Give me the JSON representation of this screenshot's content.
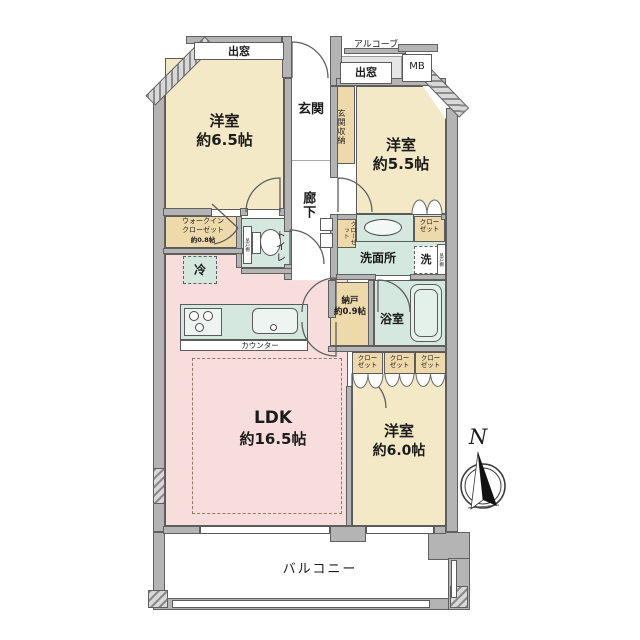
{
  "plan_type": "floor-plan",
  "rooms": {
    "bedroom_65": {
      "name": "洋室",
      "size": "約6.5帖"
    },
    "bedroom_55": {
      "name": "洋室",
      "size": "約5.5帖"
    },
    "bedroom_60": {
      "name": "洋室",
      "size": "約6.0帖"
    },
    "ldk": {
      "name": "LDK",
      "size": "約16.5帖"
    },
    "entrance": "玄関",
    "entrance_storage": "玄関収納",
    "hallway": "廊下",
    "toilet": "トイレ",
    "washroom": "洗面所",
    "bathroom": "浴室",
    "storage_room": {
      "name": "納戸",
      "size": "約0.9帖"
    },
    "walk_in_closet": {
      "line1": "ウォークイン",
      "line2": "クローゼット",
      "size": "約0.8帖"
    },
    "balcony": "バルコニー"
  },
  "features": {
    "bay_window": "出窓",
    "alcove": "アルコーブ",
    "meter_box": "MB",
    "counter": "カウンター",
    "refrigerator": "冷",
    "washing_machine": "洗",
    "closet": "クローゼット",
    "shelf": "吊戸棚"
  },
  "compass": {
    "north": "N"
  },
  "legend_colors": {
    "bedroom_fill": "#f3e9c6",
    "ldk_fill": "#f8dddd",
    "wet_area_fill": "#d5e8df",
    "storage_fill": "#eed9ab",
    "wall": "#b4b4b4"
  }
}
